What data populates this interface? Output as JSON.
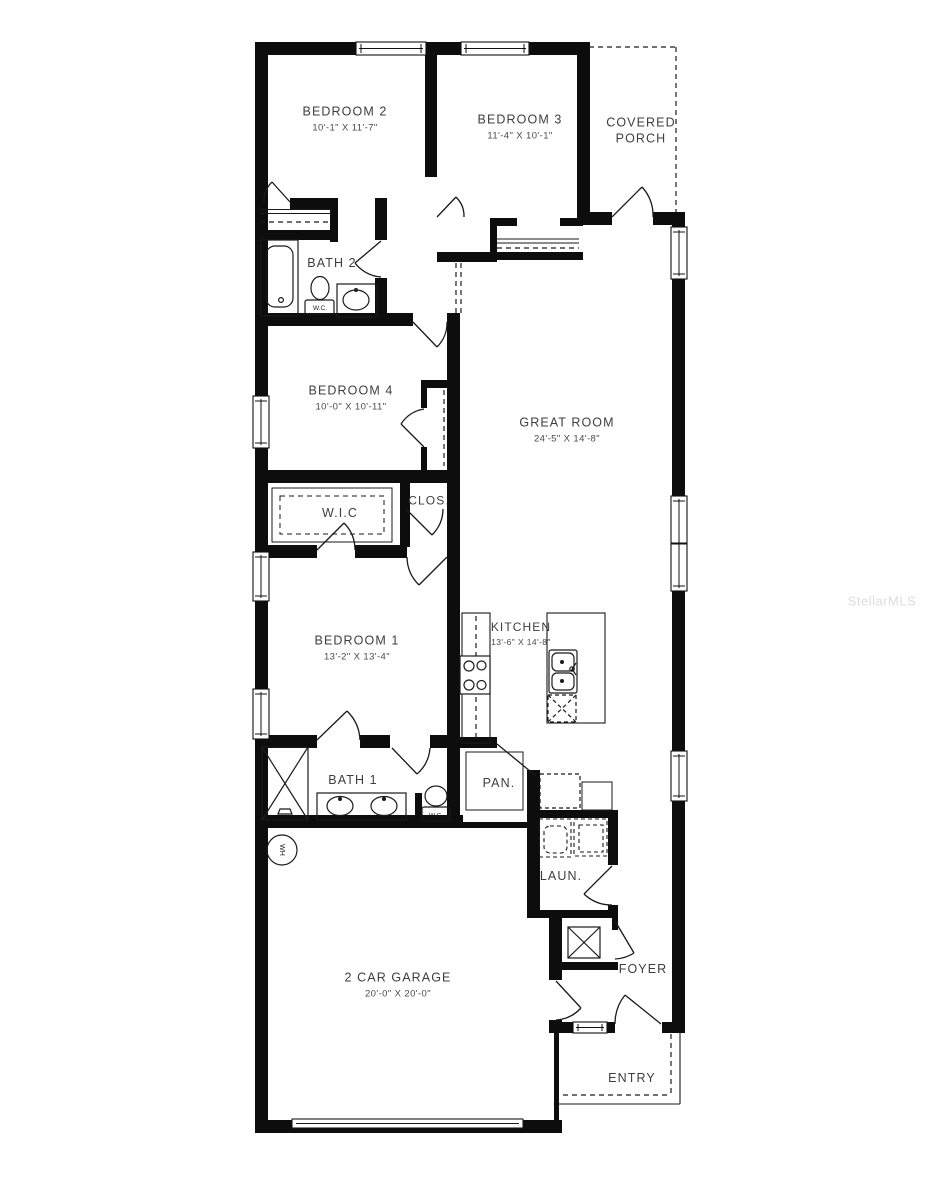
{
  "watermark": "StellarMLS",
  "rooms": {
    "bedroom2": {
      "name": "BEDROOM 2",
      "dims": "10'-1\" X 11'-7\""
    },
    "bedroom3": {
      "name": "BEDROOM 3",
      "dims": "11'-4\" X 10'-1\""
    },
    "covered_porch": {
      "name": "COVERED PORCH"
    },
    "bath2": {
      "name": "BATH 2"
    },
    "bedroom4": {
      "name": "BEDROOM 4",
      "dims": "10'-0\" X 10'-11\""
    },
    "great_room": {
      "name": "GREAT ROOM",
      "dims": "24'-5\" X 14'-8\""
    },
    "wic": {
      "name": "W.I.C"
    },
    "closet": {
      "name": "CLOS."
    },
    "bedroom1": {
      "name": "BEDROOM 1",
      "dims": "13'-2\" X 13'-4\""
    },
    "kitchen": {
      "name": "KITCHEN",
      "dims": "13'-6\" X 14'-8\""
    },
    "bath1": {
      "name": "BATH 1"
    },
    "pantry": {
      "name": "PAN."
    },
    "laundry": {
      "name": "LAUN."
    },
    "foyer": {
      "name": "FOYER"
    },
    "garage": {
      "name": "2 CAR GARAGE",
      "dims": "20'-0\" X 20'-0\""
    },
    "entry": {
      "name": "ENTRY"
    }
  },
  "fixture_labels": {
    "bath2_wc": "W.C.",
    "bath1_wc": "W.C.",
    "water_heater": "WH"
  },
  "colors": {
    "wall": "#0d0d0d",
    "line": "#1a1a1a",
    "text": "#3e3e3e",
    "watermark": "#dcdcdc",
    "background": "#ffffff"
  }
}
